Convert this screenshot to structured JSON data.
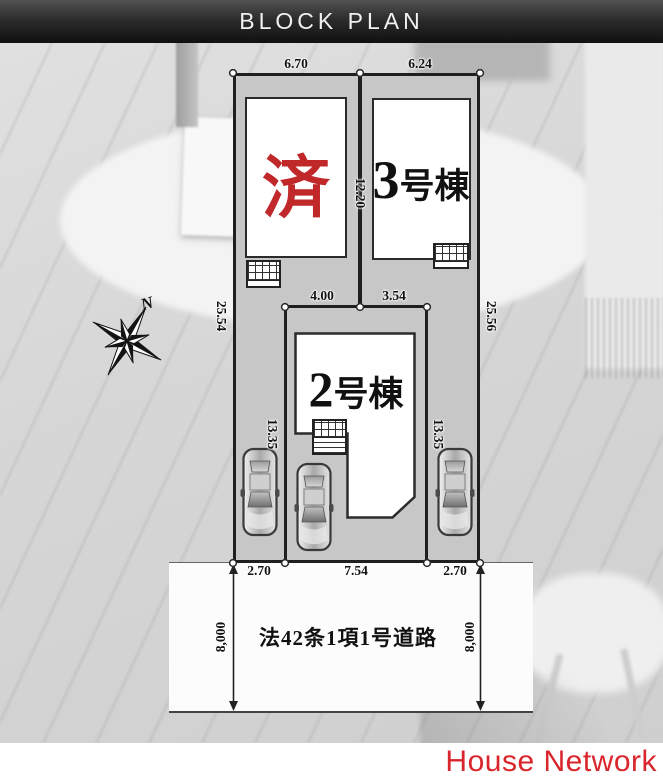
{
  "header": {
    "title": "BLOCK PLAN"
  },
  "plan": {
    "compass": {
      "label": "N"
    },
    "buildings": {
      "sold": {
        "label": "済"
      },
      "unit3": {
        "number": "3",
        "suffix": "号棟"
      },
      "unit2": {
        "number": "2",
        "suffix": "号棟"
      }
    },
    "dimensions": {
      "lot1_frontage_top": "6.70",
      "lot3_frontage_top": "6.24",
      "center_depth": "12.20",
      "site_depth_left": "25.54",
      "site_depth_right": "25.56",
      "lot2_top_left": "4.00",
      "lot2_top_right": "3.54",
      "drive_depth_left": "13.35",
      "drive_depth_right": "13.35",
      "frontage_left": "2.70",
      "frontage_center": "7.54",
      "frontage_right": "2.70"
    },
    "road": {
      "label": "法42条1項1号道路",
      "width_left": "8,000",
      "width_right": "8,000"
    }
  },
  "footer": {
    "brand": "House Network"
  },
  "colors": {
    "header_bg": "#1d1d1d",
    "lot_fill": "#c7c7c7",
    "outline": "#1f1f1f",
    "sold_red": "#c0282a",
    "brand_red": "#d9252c",
    "road_fill": "#fcfcfc"
  }
}
